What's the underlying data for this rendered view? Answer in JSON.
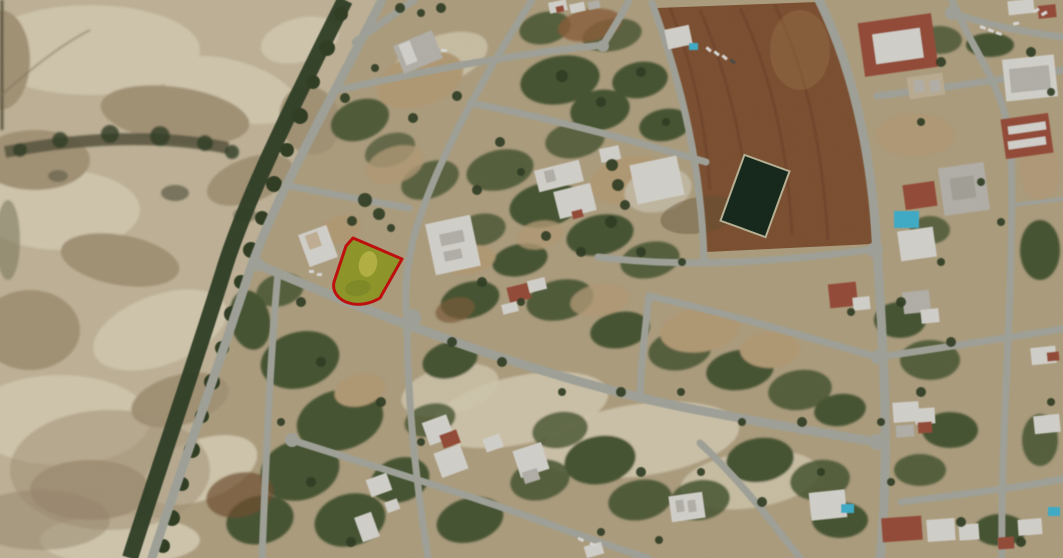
{
  "image": {
    "width": 1063,
    "height": 558,
    "description": "Aerial satellite photograph of a seaside town district: open sandy land to the west separated by a tree-lined boundary road, a fan-shaped grid of streets with vacant scrub plots, a building plot highlighted in green with a red boundary, a brown ploughed field with a dark water reservoir to the north-east, and residential houses with red roofs and swimming pools to the east."
  },
  "colors": {
    "urban_ground": "#c2b18f",
    "sand": "#d6c8aa",
    "sand_light": "#e9dec2",
    "sand_dark": "#b7a585",
    "scrub": "#51603a",
    "tan": "#c7ad84",
    "tree": "#37462a",
    "road": "#b4b6ab",
    "field": "#8d5b3a",
    "field_dark": "#72462a",
    "reservoir": "#1b2e20",
    "plot_fill": "#a2ab30",
    "plot_fill_bright": "#d2ce53",
    "plot_outline": "#d81310",
    "building_white": "#eceae3",
    "building_gray": "#c8c5bc",
    "roof_red": "#a75640",
    "pool": "#48c2e0",
    "car_white": "#f4f3ef"
  },
  "scene": {
    "type": "satellite-aerial-photo",
    "highlighted_plot": {
      "shape": "four-sided corner plot with rounded south-west corner",
      "fill": "#a2ab30",
      "outline": "#d81310",
      "position": "left-centre of the street grid, at a road junction"
    },
    "features": [
      "open sandy land on the west",
      "tree line along boundary road",
      "fan-shaped street grid",
      "vacant scrub plots",
      "ploughed brown field north-east",
      "dark green water reservoir",
      "residential houses with red roofs east",
      "blue swimming pools",
      "parked cars"
    ]
  }
}
